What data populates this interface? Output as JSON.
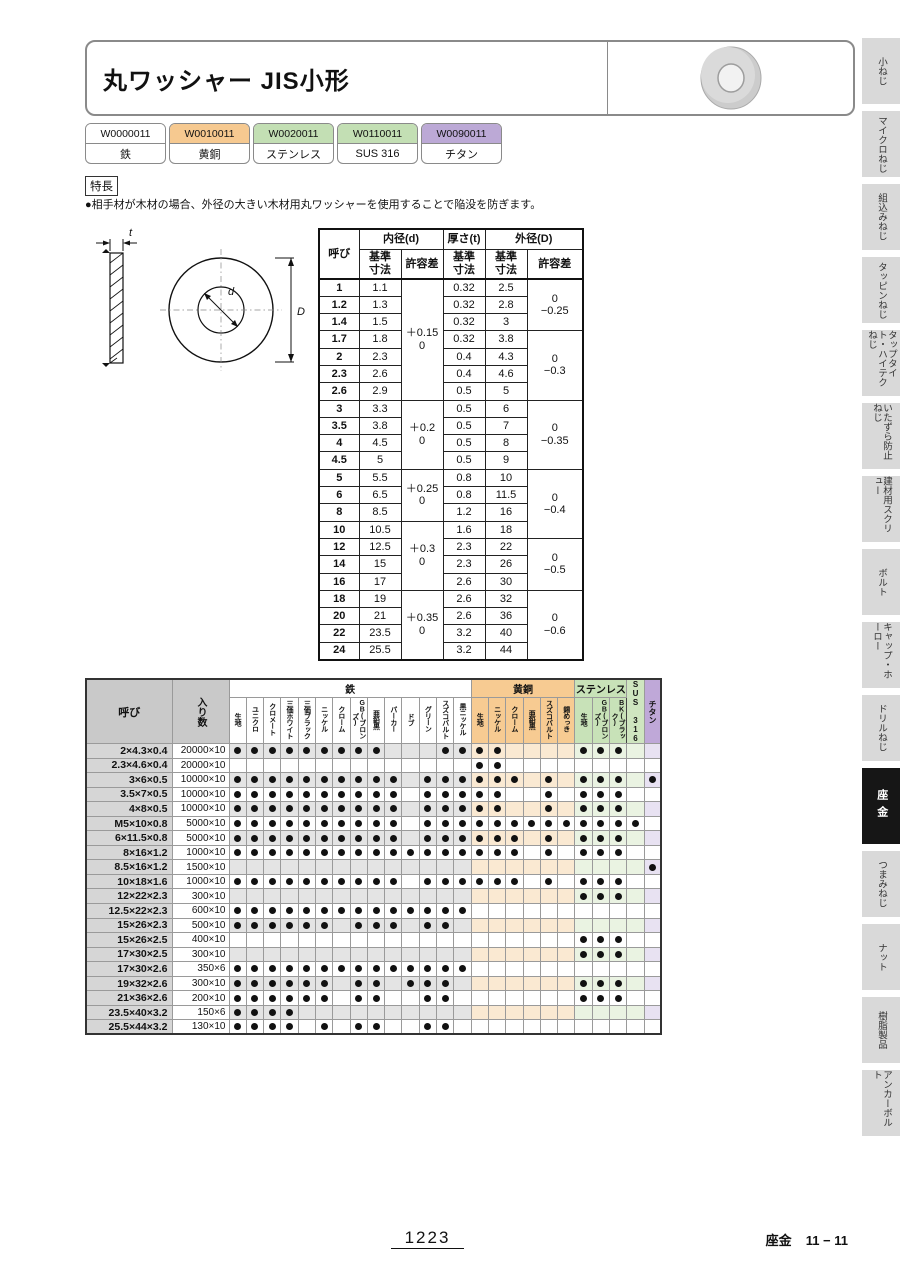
{
  "header": {
    "title": "丸ワッシャー JIS小形"
  },
  "washer_icon": "washer-photo",
  "product_codes": [
    {
      "code": "W0000011",
      "material": "鉄",
      "color": "#ffffff"
    },
    {
      "code": "W0010011",
      "material": "黄銅",
      "color": "#f6c990"
    },
    {
      "code": "W0020011",
      "material": "ステンレス",
      "color": "#c3dfb4"
    },
    {
      "code": "W0110011",
      "material": "SUS 316",
      "color": "#c3dfb4"
    },
    {
      "code": "W0090011",
      "material": "チタン",
      "color": "#bca9d6"
    }
  ],
  "features": {
    "label": "特長",
    "text": "●相手材が木材の場合、外径の大きい木材用丸ワッシャーを使用することで陥没を防ぎます。"
  },
  "diagram_labels": {
    "t": "t",
    "d": "d",
    "D": "D"
  },
  "dim_table": {
    "headers": {
      "name": "呼び",
      "inner": "内径(d)",
      "thick": "厚さ(t)",
      "outer": "外径(D)",
      "basic": "基準\n寸法",
      "tol": "許容差"
    },
    "rows": [
      [
        "1",
        "1.1",
        "0.32",
        "2.5"
      ],
      [
        "1.2",
        "1.3",
        "0.32",
        "2.8"
      ],
      [
        "1.4",
        "1.5",
        "0.32",
        "3"
      ],
      [
        "1.7",
        "1.8",
        "0.32",
        "3.8"
      ],
      [
        "2",
        "2.3",
        "0.4",
        "4.3"
      ],
      [
        "2.3",
        "2.6",
        "0.4",
        "4.6"
      ],
      [
        "2.6",
        "2.9",
        "0.5",
        "5"
      ],
      [
        "3",
        "3.3",
        "0.5",
        "6"
      ],
      [
        "3.5",
        "3.8",
        "0.5",
        "7"
      ],
      [
        "4",
        "4.5",
        "0.5",
        "8"
      ],
      [
        "4.5",
        "5",
        "0.5",
        "9"
      ],
      [
        "5",
        "5.5",
        "0.8",
        "10"
      ],
      [
        "6",
        "6.5",
        "0.8",
        "11.5"
      ],
      [
        "8",
        "8.5",
        "1.2",
        "16"
      ],
      [
        "10",
        "10.5",
        "1.6",
        "18"
      ],
      [
        "12",
        "12.5",
        "2.3",
        "22"
      ],
      [
        "14",
        "15",
        "2.3",
        "26"
      ],
      [
        "16",
        "17",
        "2.6",
        "30"
      ],
      [
        "18",
        "19",
        "2.6",
        "32"
      ],
      [
        "20",
        "21",
        "2.6",
        "36"
      ],
      [
        "22",
        "23.5",
        "3.2",
        "40"
      ],
      [
        "24",
        "25.5",
        "3.2",
        "44"
      ]
    ],
    "id_tol_groups": [
      {
        "start": 0,
        "span": 7,
        "label": "＋0.15\n0"
      },
      {
        "start": 7,
        "span": 4,
        "label": "＋0.2\n0"
      },
      {
        "start": 11,
        "span": 3,
        "label": "＋0.25\n0"
      },
      {
        "start": 14,
        "span": 4,
        "label": "＋0.3\n0"
      },
      {
        "start": 18,
        "span": 4,
        "label": "＋0.35\n0"
      }
    ],
    "od_tol_groups": [
      {
        "start": 0,
        "span": 3,
        "label": "0\n−0.25"
      },
      {
        "start": 3,
        "span": 4,
        "label": "0\n−0.3"
      },
      {
        "start": 7,
        "span": 4,
        "label": "0\n−0.35"
      },
      {
        "start": 11,
        "span": 4,
        "label": "0\n−0.4"
      },
      {
        "start": 15,
        "span": 3,
        "label": "0\n−0.5"
      },
      {
        "start": 18,
        "span": 4,
        "label": "0\n−0.6"
      }
    ]
  },
  "matrix": {
    "name_header": "呼び",
    "qty_header": "入り数",
    "groups": [
      {
        "label": "鉄",
        "header_color": "#ffffff",
        "tint": "#e4e4e4",
        "cols": [
          "生地",
          "ユニクロ",
          "クロメート",
          "三価ホワイト",
          "三価ブラック",
          "ニッケル",
          "クローム",
          "GB(ブロンズ)",
          "亜鉛黒",
          "パーカー",
          "ドブ",
          "グリーン",
          "スズコバルト",
          "黒ニッケル"
        ]
      },
      {
        "label": "黄銅",
        "header_color": "#f7cb92",
        "tint": "#fae9d2",
        "cols": [
          "生地",
          "ニッケル",
          "クローム",
          "亜鉛黒",
          "スズコバルト",
          "錫めっき"
        ]
      },
      {
        "label": "ステンレス",
        "header_color": "#c8e2b8",
        "tint": "#eaf3e2",
        "cols": [
          "生地",
          "GB(ブロンズ)",
          "BK(ブラック)"
        ]
      },
      {
        "label": "SUS 316",
        "header_color": "#cfe5c0",
        "tint": "#eaf3e2",
        "cols": null
      },
      {
        "label": "チタン",
        "header_color": "#bfa8d8",
        "tint": "#e8e2f2",
        "cols": null
      }
    ],
    "rows": [
      {
        "name": "2×4.3×0.4",
        "qty": "20000×10",
        "dots": [
          1,
          2,
          3,
          4,
          5,
          6,
          7,
          8,
          9,
          13,
          14,
          15,
          16,
          21,
          22,
          23
        ]
      },
      {
        "name": "2.3×4.6×0.4",
        "qty": "20000×10",
        "dots": [
          15,
          16
        ]
      },
      {
        "name": "3×6×0.5",
        "qty": "10000×10",
        "dots": [
          1,
          2,
          3,
          4,
          5,
          6,
          7,
          8,
          9,
          10,
          12,
          13,
          14,
          15,
          16,
          17,
          19,
          21,
          22,
          23,
          25
        ]
      },
      {
        "name": "3.5×7×0.5",
        "qty": "10000×10",
        "dots": [
          1,
          2,
          3,
          4,
          5,
          6,
          7,
          8,
          9,
          10,
          12,
          13,
          14,
          15,
          16,
          19,
          21,
          22,
          23
        ]
      },
      {
        "name": "4×8×0.5",
        "qty": "10000×10",
        "dots": [
          1,
          2,
          3,
          4,
          5,
          6,
          7,
          8,
          9,
          10,
          12,
          13,
          14,
          15,
          16,
          19,
          21,
          22,
          23
        ]
      },
      {
        "name": "M5×10×0.8",
        "qty": "5000×10",
        "dots": [
          1,
          2,
          3,
          4,
          5,
          6,
          7,
          8,
          9,
          10,
          12,
          13,
          14,
          15,
          16,
          17,
          18,
          19,
          20,
          21,
          22,
          23,
          24
        ]
      },
      {
        "name": "6×11.5×0.8",
        "qty": "5000×10",
        "dots": [
          1,
          2,
          3,
          4,
          5,
          6,
          7,
          8,
          9,
          10,
          12,
          13,
          14,
          15,
          16,
          17,
          19,
          21,
          22,
          23
        ]
      },
      {
        "name": "8×16×1.2",
        "qty": "1000×10",
        "dots": [
          1,
          2,
          3,
          4,
          5,
          6,
          7,
          8,
          9,
          10,
          11,
          12,
          13,
          14,
          15,
          16,
          17,
          19,
          21,
          22,
          23
        ]
      },
      {
        "name": "8.5×16×1.2",
        "qty": "1500×10",
        "dots": [
          25
        ]
      },
      {
        "name": "10×18×1.6",
        "qty": "1000×10",
        "dots": [
          1,
          2,
          3,
          4,
          5,
          6,
          7,
          8,
          9,
          10,
          12,
          13,
          14,
          15,
          16,
          17,
          19,
          21,
          22,
          23
        ]
      },
      {
        "name": "12×22×2.3",
        "qty": "300×10",
        "dots": [
          21,
          22,
          23
        ]
      },
      {
        "name": "12.5×22×2.3",
        "qty": "600×10",
        "dots": [
          1,
          2,
          3,
          4,
          5,
          6,
          7,
          8,
          9,
          10,
          11,
          12,
          13,
          14
        ]
      },
      {
        "name": "15×26×2.3",
        "qty": "500×10",
        "dots": [
          1,
          2,
          3,
          4,
          5,
          6,
          8,
          9,
          10,
          12,
          13
        ]
      },
      {
        "name": "15×26×2.5",
        "qty": "400×10",
        "dots": [
          21,
          22,
          23
        ]
      },
      {
        "name": "17×30×2.5",
        "qty": "300×10",
        "dots": [
          21,
          22,
          23
        ]
      },
      {
        "name": "17×30×2.6",
        "qty": "350×6",
        "dots": [
          1,
          2,
          3,
          4,
          5,
          6,
          7,
          8,
          9,
          10,
          11,
          12,
          13,
          14
        ]
      },
      {
        "name": "19×32×2.6",
        "qty": "300×10",
        "dots": [
          1,
          2,
          3,
          4,
          5,
          6,
          8,
          9,
          11,
          12,
          13,
          21,
          22,
          23
        ]
      },
      {
        "name": "21×36×2.6",
        "qty": "200×10",
        "dots": [
          1,
          2,
          3,
          4,
          5,
          6,
          8,
          9,
          12,
          13,
          21,
          22,
          23
        ]
      },
      {
        "name": "23.5×40×3.2",
        "qty": "150×6",
        "dots": [
          1,
          2,
          3,
          4
        ]
      },
      {
        "name": "25.5×44×3.2",
        "qty": "130×10",
        "dots": [
          1,
          2,
          3,
          4,
          6,
          8,
          9,
          12,
          13
        ]
      }
    ]
  },
  "sidebar": {
    "tabs": [
      {
        "label": "小ねじ",
        "active": false
      },
      {
        "label": "マイクロねじ",
        "active": false
      },
      {
        "label": "組込みねじ",
        "active": false
      },
      {
        "label": "タッピンねじ",
        "active": false
      },
      {
        "label": "タップタイト・ハイテクねじ",
        "active": false
      },
      {
        "label": "いたずら防止ねじ",
        "active": false
      },
      {
        "label": "建材用スクリュー",
        "active": false
      },
      {
        "label": "ボルト",
        "active": false
      },
      {
        "label": "キャップ・ホーロー",
        "active": false
      },
      {
        "label": "ドリルねじ",
        "active": false
      },
      {
        "label": "座金",
        "active": true
      },
      {
        "label": "つまみねじ",
        "active": false
      },
      {
        "label": "ナット",
        "active": false
      },
      {
        "label": "樹脂製品",
        "active": false
      },
      {
        "label": "アンカーボルト",
        "active": false
      }
    ]
  },
  "footer": {
    "page": "1223",
    "section": "座金",
    "code": "11 − 11"
  }
}
